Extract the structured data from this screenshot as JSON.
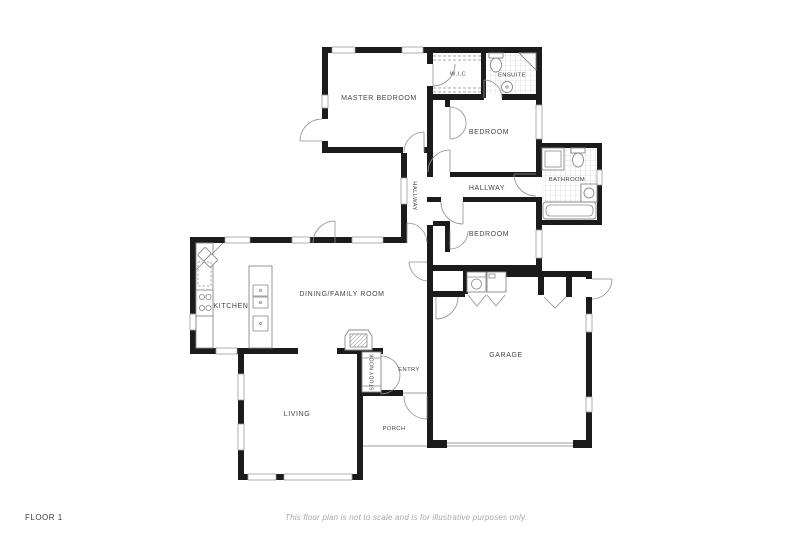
{
  "footer": {
    "floor_label": "FLOOR 1",
    "disclaimer": "This floor plan is not to scale and is for illustrative purposes only."
  },
  "rooms": {
    "master_bedroom": "MASTER BEDROOM",
    "wic": "W.I.C",
    "ensuite": "ENSUITE",
    "bedroom_upper": "BEDROOM",
    "hallway": "HALLWAY",
    "hallway_vertical": "HALLWAY",
    "bathroom": "BATHROOM",
    "bedroom_lower": "BEDROOM",
    "kitchen": "KITCHEN",
    "dining_family": "DINING/FAMILY ROOM",
    "garage": "GARAGE",
    "entry": "ENTRY",
    "study_nook": "STUDY NOOK",
    "living": "LIVING",
    "porch": "PORCH"
  },
  "colors": {
    "page_bg": "#ffffff",
    "wall": "#1b1b1b",
    "door": "#8f8f8f",
    "window": "#9c9c9c",
    "fixture": "#8a8a8a",
    "tile": "#c9c9c9",
    "label": "#454545",
    "footer_label": "#3c3c3c",
    "disclaimer": "#a8a8a8"
  }
}
